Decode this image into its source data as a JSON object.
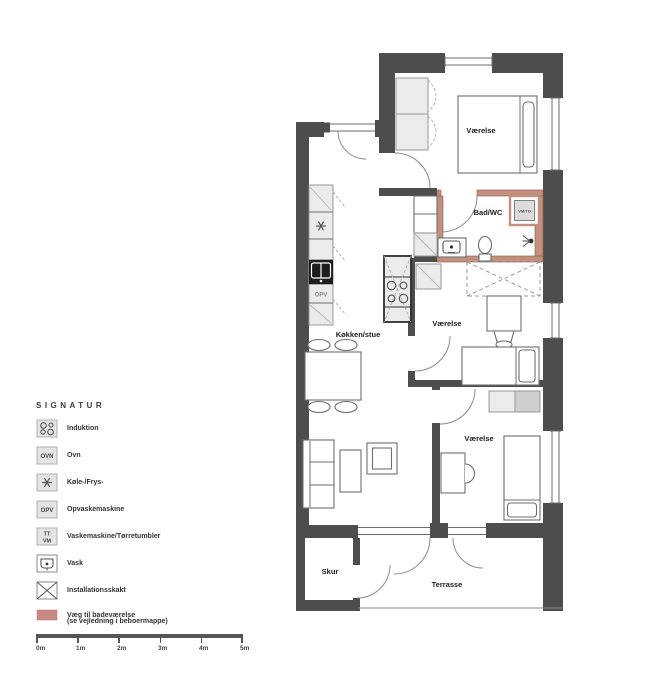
{
  "colors": {
    "wall": "#4d4d4d",
    "bath_wall": "#c2907f",
    "bath_wall_stroke": "#91584a",
    "swatch": "#c98a86"
  },
  "plan": {
    "rooms": {
      "bedroom_top": "Værelse",
      "bathroom": "Bad/WC",
      "kitchen_living": "Køkken/stue",
      "bedroom_middle": "Værelse",
      "bedroom_bottom": "Værelse",
      "shed": "Skur",
      "terrace": "Terrasse"
    },
    "labels": {
      "dishwasher": "OPV",
      "washer_dryer_box": "VM/TD"
    }
  },
  "legend": {
    "title": "SIGNATUR",
    "items": [
      {
        "icon": "induction-icon",
        "label": "Induktion"
      },
      {
        "icon": "oven-icon",
        "icon_text": "OVN",
        "label": "Ovn"
      },
      {
        "icon": "fridge-freezer-icon",
        "label": "Køle-/Frys-"
      },
      {
        "icon": "dishwasher-icon",
        "icon_text": "OPV",
        "label": "Opvaskemaskine"
      },
      {
        "icon": "washer-dryer-icon",
        "icon_text_top": "TT",
        "icon_text_bottom": "VM",
        "label": "Vaskemaskine/Tørretumbler"
      },
      {
        "icon": "sink-icon",
        "label": "Vask"
      },
      {
        "icon": "installation-shaft-icon",
        "label": "Installationsskakt"
      },
      {
        "icon": "bathroom-wall-swatch",
        "label": "Væg til badeværelse",
        "label_note": "(se vejledning i beboermappe)"
      }
    ]
  },
  "scalebar": {
    "labels": [
      "0m",
      "1m",
      "2m",
      "3m",
      "4m",
      "5m"
    ]
  }
}
